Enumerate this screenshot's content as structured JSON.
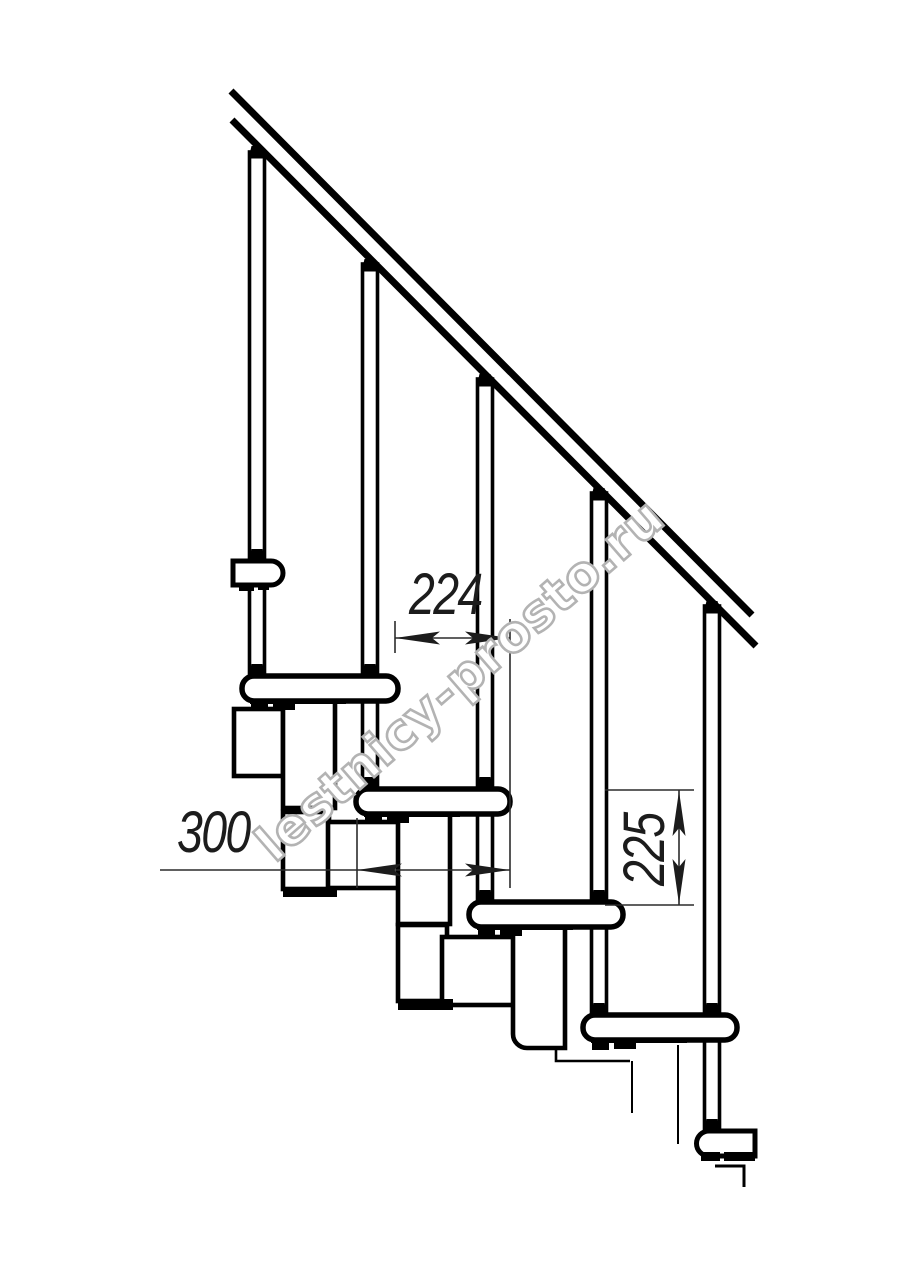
{
  "drawing": {
    "watermark": {
      "text": "lestnicy-prosto.ru"
    },
    "dimensions": {
      "step_width_224": {
        "label": "224",
        "orientation": "horizontal"
      },
      "tread_depth_300": {
        "label": "300",
        "orientation": "horizontal"
      },
      "riser_height_225": {
        "label": "225",
        "orientation": "vertical"
      }
    },
    "colors": {
      "line": "#000000",
      "dimension": "#1c1c1c",
      "watermark": "#b3b3b3",
      "background": "#ffffff"
    }
  }
}
